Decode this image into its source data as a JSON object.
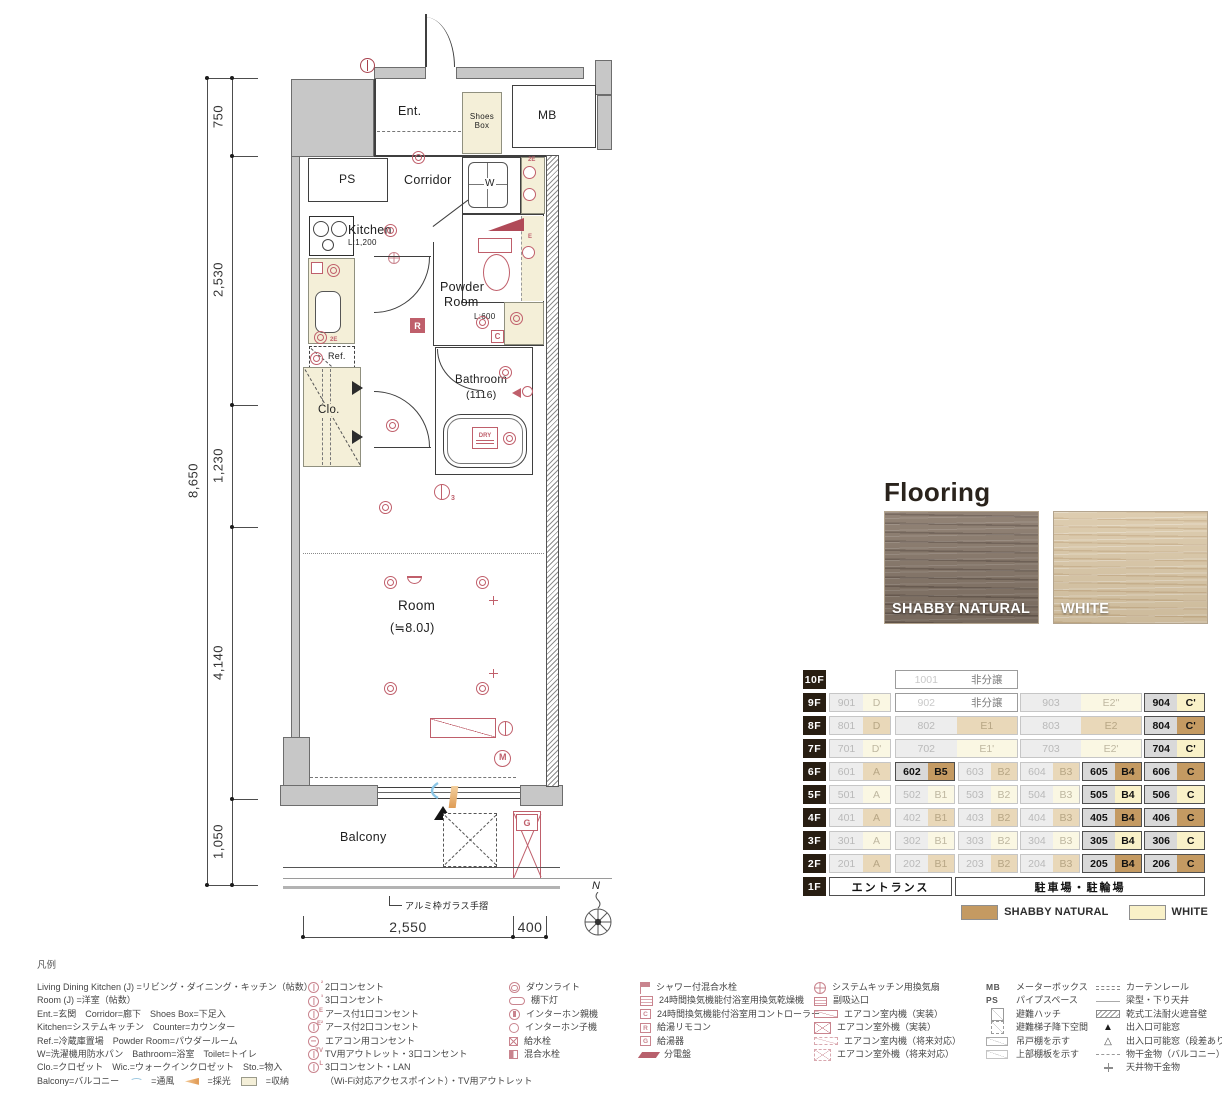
{
  "plan": {
    "rooms": {
      "ent": "Ent.",
      "shoes_box": "Shoes Box",
      "mb": "MB",
      "ps": "PS",
      "corridor": "Corridor",
      "w": "W",
      "kitchen": "Kitchen",
      "kitchen_counter_len": "L:1,200",
      "powder_1": "Powder",
      "powder_2": "Room",
      "powder_len": "L:600",
      "ref": "Ref.",
      "bathroom": "Bathroom",
      "bathroom_size": "(1116)",
      "clo": "Clo.",
      "room": "Room",
      "room_size": "(≒8.0J)",
      "balcony": "Balcony"
    },
    "badges": {
      "r": "R",
      "c": "C",
      "m": "M",
      "g": "G",
      "e": "E",
      "two_e": "2E",
      "dry": "DRY",
      "three": "3",
      "north": "N"
    },
    "dimensions": {
      "overall_height": "8,650",
      "seg_750": "750",
      "seg_2530": "2,530",
      "seg_1230": "1,230",
      "seg_4140": "4,140",
      "seg_1050": "1,050",
      "width_main": "2,550",
      "width_side": "400"
    },
    "notes": {
      "handrail": "アルミ枠ガラス手摺"
    }
  },
  "flooring": {
    "title": "Flooring",
    "swatches": [
      {
        "label": "SHABBY NATURAL",
        "color": "#8a7a6c"
      },
      {
        "label": "WHITE",
        "color": "#d9c6a5"
      }
    ]
  },
  "stack": {
    "swatches": [
      {
        "label": "SHABBY NATURAL",
        "color": "#c49a62"
      },
      {
        "label": "WHITE",
        "color": "#f9f1c8"
      }
    ],
    "rows": [
      {
        "floor": "10F",
        "cells": [
          {
            "no": "1001",
            "type": "非分譲",
            "state": "not_for_sale"
          }
        ]
      },
      {
        "floor": "9F",
        "cells": [
          {
            "no": "901",
            "type": "D",
            "state": "sold",
            "flooring": "WHITE"
          },
          {
            "no": "902",
            "type": "非分譲",
            "state": "not_for_sale"
          },
          {
            "no": "903",
            "type": "E2''",
            "state": "sold",
            "flooring": "WHITE"
          },
          {
            "no": "904",
            "type": "C'",
            "state": "available",
            "flooring": "WHITE"
          }
        ]
      },
      {
        "floor": "8F",
        "cells": [
          {
            "no": "801",
            "type": "D",
            "state": "sold",
            "flooring": "SHABBY NATURAL"
          },
          {
            "no": "802",
            "type": "E1",
            "state": "sold",
            "flooring": "SHABBY NATURAL"
          },
          {
            "no": "803",
            "type": "E2",
            "state": "sold",
            "flooring": "SHABBY NATURAL"
          },
          {
            "no": "804",
            "type": "C'",
            "state": "available",
            "flooring": "SHABBY NATURAL"
          }
        ]
      },
      {
        "floor": "7F",
        "cells": [
          {
            "no": "701",
            "type": "D'",
            "state": "sold",
            "flooring": "WHITE"
          },
          {
            "no": "702",
            "type": "E1'",
            "state": "sold",
            "flooring": "WHITE"
          },
          {
            "no": "703",
            "type": "E2'",
            "state": "sold",
            "flooring": "WHITE"
          },
          {
            "no": "704",
            "type": "C'",
            "state": "available",
            "flooring": "WHITE"
          }
        ]
      },
      {
        "floor": "6F",
        "cells": [
          {
            "no": "601",
            "type": "A",
            "state": "sold",
            "flooring": "SHABBY NATURAL"
          },
          {
            "no": "602",
            "type": "B5",
            "state": "available",
            "flooring": "SHABBY NATURAL"
          },
          {
            "no": "603",
            "type": "B2",
            "state": "sold",
            "flooring": "SHABBY NATURAL"
          },
          {
            "no": "604",
            "type": "B3",
            "state": "sold",
            "flooring": "SHABBY NATURAL"
          },
          {
            "no": "605",
            "type": "B4",
            "state": "available",
            "flooring": "SHABBY NATURAL"
          },
          {
            "no": "606",
            "type": "C",
            "state": "available",
            "flooring": "SHABBY NATURAL"
          }
        ]
      },
      {
        "floor": "5F",
        "cells": [
          {
            "no": "501",
            "type": "A",
            "state": "sold",
            "flooring": "WHITE"
          },
          {
            "no": "502",
            "type": "B1",
            "state": "sold",
            "flooring": "WHITE"
          },
          {
            "no": "503",
            "type": "B2",
            "state": "sold",
            "flooring": "WHITE"
          },
          {
            "no": "504",
            "type": "B3",
            "state": "sold",
            "flooring": "WHITE"
          },
          {
            "no": "505",
            "type": "B4",
            "state": "available",
            "flooring": "WHITE"
          },
          {
            "no": "506",
            "type": "C",
            "state": "available",
            "flooring": "WHITE"
          }
        ]
      },
      {
        "floor": "4F",
        "cells": [
          {
            "no": "401",
            "type": "A",
            "state": "sold",
            "flooring": "SHABBY NATURAL"
          },
          {
            "no": "402",
            "type": "B1",
            "state": "sold",
            "flooring": "SHABBY NATURAL"
          },
          {
            "no": "403",
            "type": "B2",
            "state": "sold",
            "flooring": "SHABBY NATURAL"
          },
          {
            "no": "404",
            "type": "B3",
            "state": "sold",
            "flooring": "SHABBY NATURAL"
          },
          {
            "no": "405",
            "type": "B4",
            "state": "available",
            "flooring": "SHABBY NATURAL"
          },
          {
            "no": "406",
            "type": "C",
            "state": "available",
            "flooring": "SHABBY NATURAL"
          }
        ]
      },
      {
        "floor": "3F",
        "cells": [
          {
            "no": "301",
            "type": "A",
            "state": "sold",
            "flooring": "WHITE"
          },
          {
            "no": "302",
            "type": "B1",
            "state": "sold",
            "flooring": "WHITE"
          },
          {
            "no": "303",
            "type": "B2",
            "state": "sold",
            "flooring": "WHITE"
          },
          {
            "no": "304",
            "type": "B3",
            "state": "sold",
            "flooring": "WHITE"
          },
          {
            "no": "305",
            "type": "B4",
            "state": "available",
            "flooring": "WHITE"
          },
          {
            "no": "306",
            "type": "C",
            "state": "available",
            "flooring": "WHITE"
          }
        ]
      },
      {
        "floor": "2F",
        "cells": [
          {
            "no": "201",
            "type": "A",
            "state": "sold",
            "flooring": "SHABBY NATURAL"
          },
          {
            "no": "202",
            "type": "B1",
            "state": "sold",
            "flooring": "SHABBY NATURAL"
          },
          {
            "no": "203",
            "type": "B2",
            "state": "sold",
            "flooring": "SHABBY NATURAL"
          },
          {
            "no": "204",
            "type": "B3",
            "state": "sold",
            "flooring": "SHABBY NATURAL"
          },
          {
            "no": "205",
            "type": "B4",
            "state": "available",
            "flooring": "SHABBY NATURAL"
          },
          {
            "no": "206",
            "type": "C",
            "state": "available",
            "flooring": "SHABBY NATURAL"
          }
        ]
      },
      {
        "floor": "1F",
        "cells": [
          {
            "label": "エントランス"
          },
          {
            "label": "駐車場・駐輪場"
          }
        ]
      }
    ]
  },
  "legend": {
    "title": "凡例",
    "terms": [
      "Living Dining Kitchen (J) =リビング・ダイニング・キッチン（帖数）",
      "Room (J) =洋室（帖数）",
      "Ent.=玄関　Corridor=廊下　Shoes Box=下足入",
      "Kitchen=システムキッチン　Counter=カウンター",
      "Ref.=冷蔵庫置場　Powder Room=パウダールーム",
      "W=洗濯機用防水パン　Bathroom=浴室　Toilet=トイレ",
      "Clo.=クロゼット　Wic.=ウォークインクロゼット　Sto.=物入"
    ],
    "terms_last": {
      "balcony": "Balcony=バルコニー",
      "vent": "=通風",
      "light": "=採光",
      "storage": "=収納"
    },
    "outlets": [
      "2口コンセント",
      "3口コンセント",
      "アース付1口コンセント",
      "アース付2口コンセント",
      "エアコン用コンセント",
      "TV用アウトレット・3口コンセント"
    ],
    "outlet_lan": {
      "line1": "3口コンセント・LAN",
      "line2": "（Wi-Fi対応アクセスポイント）・TV用アウトレット"
    },
    "fixtures": [
      "ダウンライト",
      "棚下灯",
      "インターホン親機",
      "インターホン子機",
      "給水栓",
      "混合水栓"
    ],
    "bath": [
      "シャワー付混合水栓",
      "24時間換気機能付浴室用換気乾燥機",
      "24時間換気機能付浴室用コントローラー",
      "給湯リモコン",
      "給湯器",
      "分電盤"
    ],
    "aircon": [
      "システムキッチン用換気扇",
      "副吸込口",
      "エアコン室内機（実装）",
      "エアコン室外機（実装）",
      "エアコン室内機（将来対応）",
      "エアコン室外機（将来対応）"
    ],
    "misc": {
      "mb_abbr": "MB",
      "mb": "メーターボックス",
      "ps_abbr": "PS",
      "ps": "パイプスペース",
      "others": [
        "避難ハッチ",
        "避難梯子降下空間",
        "吊戸棚を示す",
        "上部棚板を示す"
      ]
    },
    "build": [
      "カーテンレール",
      "梁型・下り天井",
      "乾式工法耐火遮音壁",
      "出入口可能窓",
      "出入口可能窓（段差あり）",
      "物干金物（バルコニー）",
      "天井物干金物"
    ]
  },
  "colors": {
    "accent_red": "#bf5f6b",
    "wall_gray": "#c7c7c7",
    "floor_label_bg": "#281e12",
    "shabby_available": "#c49a62",
    "white_available": "#f9f1c8",
    "shabby_sold": "#e9d8b9",
    "white_sold": "#faf7e3"
  }
}
